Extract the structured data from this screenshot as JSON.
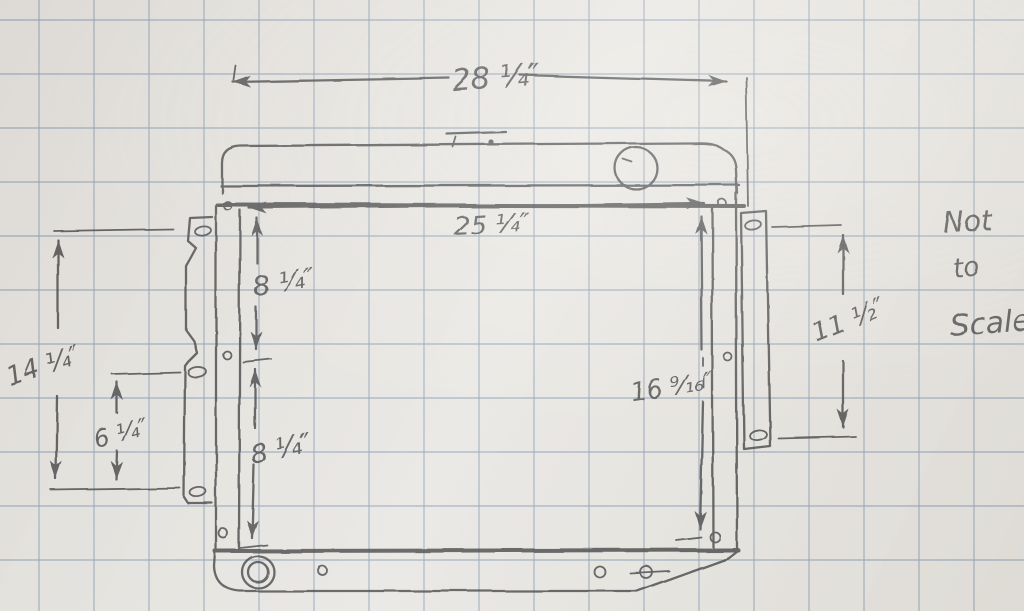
{
  "dimensions": {
    "overall_width": "28 ¼″",
    "core_mount_width": "25 ¼″",
    "upper_left_spacing": "8 ¼″",
    "lower_left_spacing": "8 ¼″",
    "right_mount_height": "16 ⁹⁄₁₆″",
    "left_bracket_height": "14 ¼″",
    "left_bracket_hole_spacing": "6 ¼″",
    "right_bracket_hole_spacing": "11 ½″"
  },
  "note": {
    "line1": "Not",
    "line2": "to",
    "line3": "Scale"
  },
  "colors": {
    "paper": "#eae8e4",
    "grid": "#b4bfc9",
    "pencil": "#4d4d50"
  }
}
